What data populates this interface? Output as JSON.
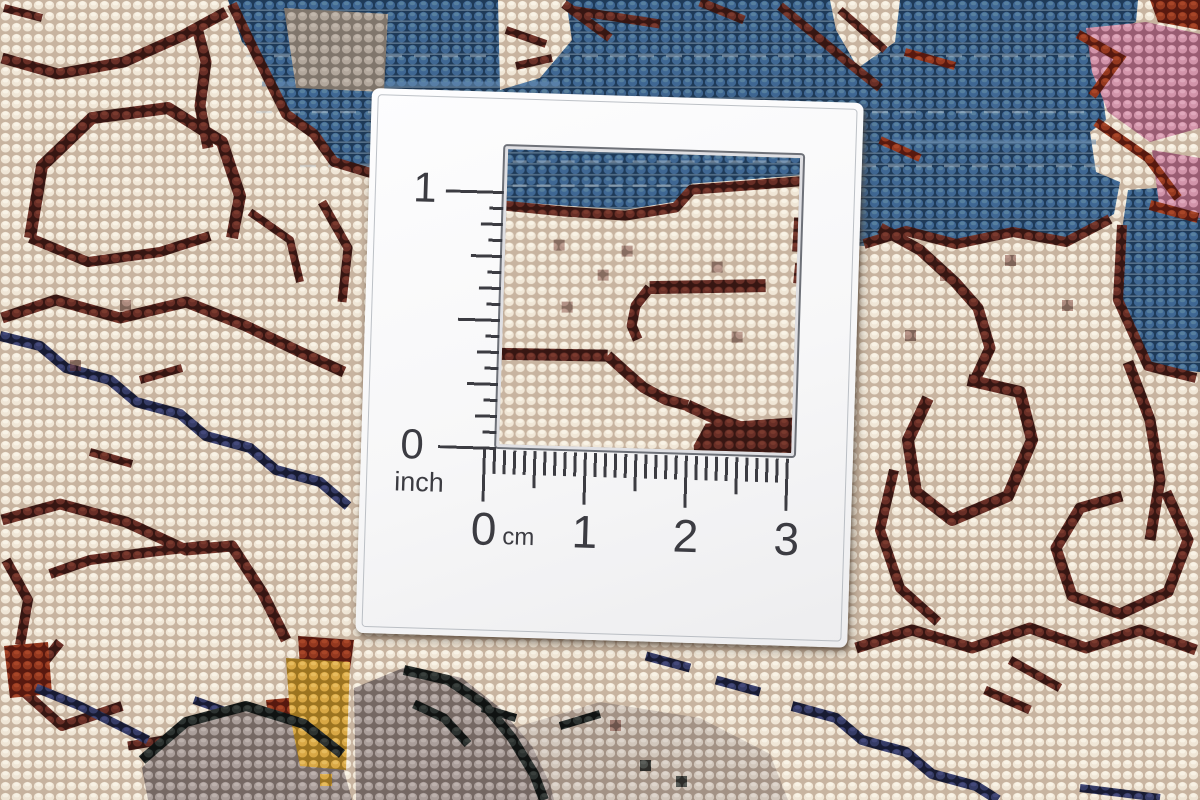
{
  "scene": {
    "description": "Close-up photograph of the knotted reverse side of an oriental wool rug with a white L-shaped measuring card laid on top; a square cutout in the card reveals the weave, with an inch scale running vertically and a centimetre scale running horizontally around the cutout.",
    "carpet_palette": {
      "cream_ground": "#f0e6d6",
      "weave_gap": "#c8b4a0",
      "maroon_scrollwork": "#682e26",
      "steel_blue_field": "#3f6793",
      "rose_pink_accent": "#d294aa",
      "navy_accent": "#363c66",
      "gray_mauve_accent": "#aa9e9a",
      "gold_accent": "#d9a845",
      "black_outline": "#2c3230",
      "rust_red_accent": "#94381f"
    },
    "card_color": "#fbfbfc",
    "ruler_ink_color": "#3c3c42"
  },
  "measuring_card": {
    "inch_ruler": {
      "one_label": "1",
      "zero_label": "0",
      "unit_label": "inch"
    },
    "cm_ruler": {
      "tick_labels": [
        "0",
        "1",
        "2",
        "3"
      ],
      "unit_label": "cm"
    }
  }
}
